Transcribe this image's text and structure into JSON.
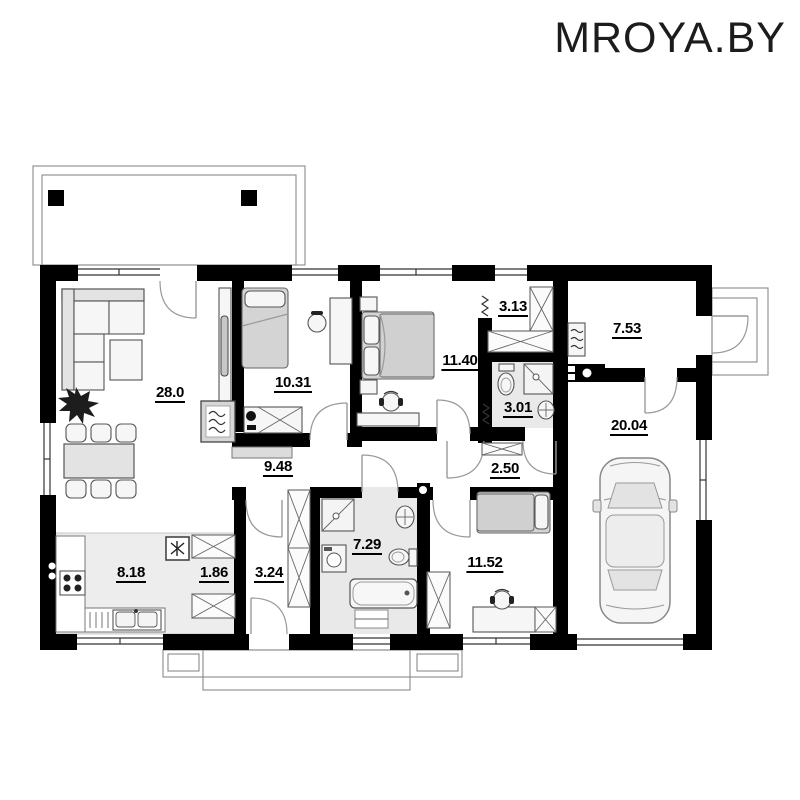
{
  "brand": {
    "logo_text": "MROYA.BY"
  },
  "rooms": {
    "living": {
      "name": "living-room",
      "area": "28.0"
    },
    "bedroom1": {
      "name": "bedroom-1",
      "area": "10.31"
    },
    "bedroom2": {
      "name": "bedroom-2",
      "area": "11.40"
    },
    "wardrobe": {
      "name": "wardrobe",
      "area": "3.13"
    },
    "bathroom2": {
      "name": "bathroom-small",
      "area": "3.01"
    },
    "boiler": {
      "name": "boiler-room",
      "area": "7.53"
    },
    "garage": {
      "name": "garage",
      "area": "20.04"
    },
    "hallway": {
      "name": "hallway",
      "area": "9.48"
    },
    "hallway2": {
      "name": "hallway-2",
      "area": "2.50"
    },
    "bathroom1": {
      "name": "bathroom",
      "area": "7.29"
    },
    "bedroom3": {
      "name": "bedroom-3",
      "area": "11.52"
    },
    "kitchen": {
      "name": "kitchen",
      "area": "8.18"
    },
    "pantry": {
      "name": "pantry",
      "area": "1.86"
    },
    "vestibule": {
      "name": "vestibule",
      "area": "3.24"
    }
  },
  "colors": {
    "wall": "#000000",
    "line": "#888888",
    "furniture": "#e6e6e6",
    "text": "#111111"
  }
}
